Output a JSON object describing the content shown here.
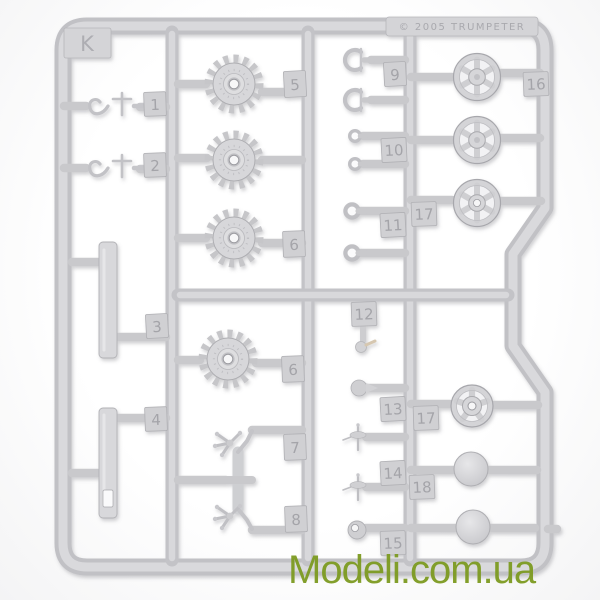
{
  "photo": {
    "description_colors": {
      "plastic": "#d2d2d5",
      "background": "#fdfdfd"
    }
  },
  "sprue": {
    "letter": "K",
    "copyright": "© 2005  TRUMPETER",
    "tags": {
      "t1": "1",
      "t2": "2",
      "t3": "3",
      "t4": "4",
      "t5": "5",
      "t6a": "6",
      "t6b": "6",
      "t7": "7",
      "t8": "8",
      "t9": "9",
      "t10": "10",
      "t11": "11",
      "t12": "12",
      "t13": "13",
      "t14": "14",
      "t15": "15",
      "t16": "16",
      "t17a": "17",
      "t17b": "17",
      "t18": "18"
    }
  },
  "watermark": {
    "text": "Modeli.com.ua",
    "color": "#7d9b21"
  }
}
